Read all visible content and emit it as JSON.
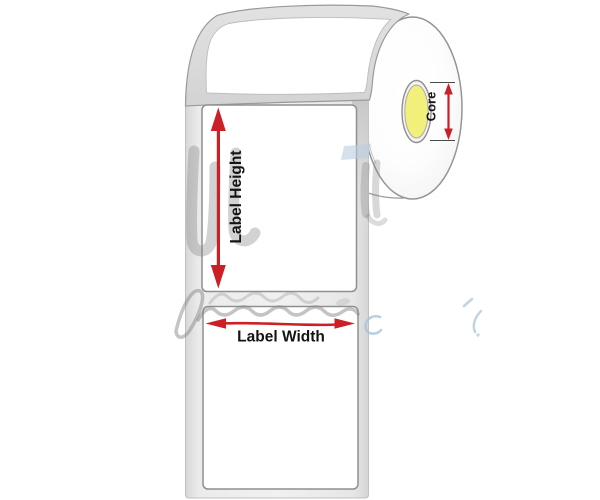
{
  "figure": {
    "type": "diagram",
    "subject": "Label roll with dimension annotations",
    "annotations": {
      "label_height": "Label Height",
      "label_width": "Label Width",
      "core": "Core"
    },
    "colors": {
      "arrow_red": "#cb2026",
      "core_yellow": "#f3ef7b",
      "liner_gray": "#dcdcdc",
      "strip_gray": "#ededed",
      "outline_gray": "#959595",
      "label_white": "#ffffff",
      "background": "#ffffff",
      "watermark_gray": "#8a8a8a",
      "watermark_blue": "#a9c4dd"
    }
  }
}
